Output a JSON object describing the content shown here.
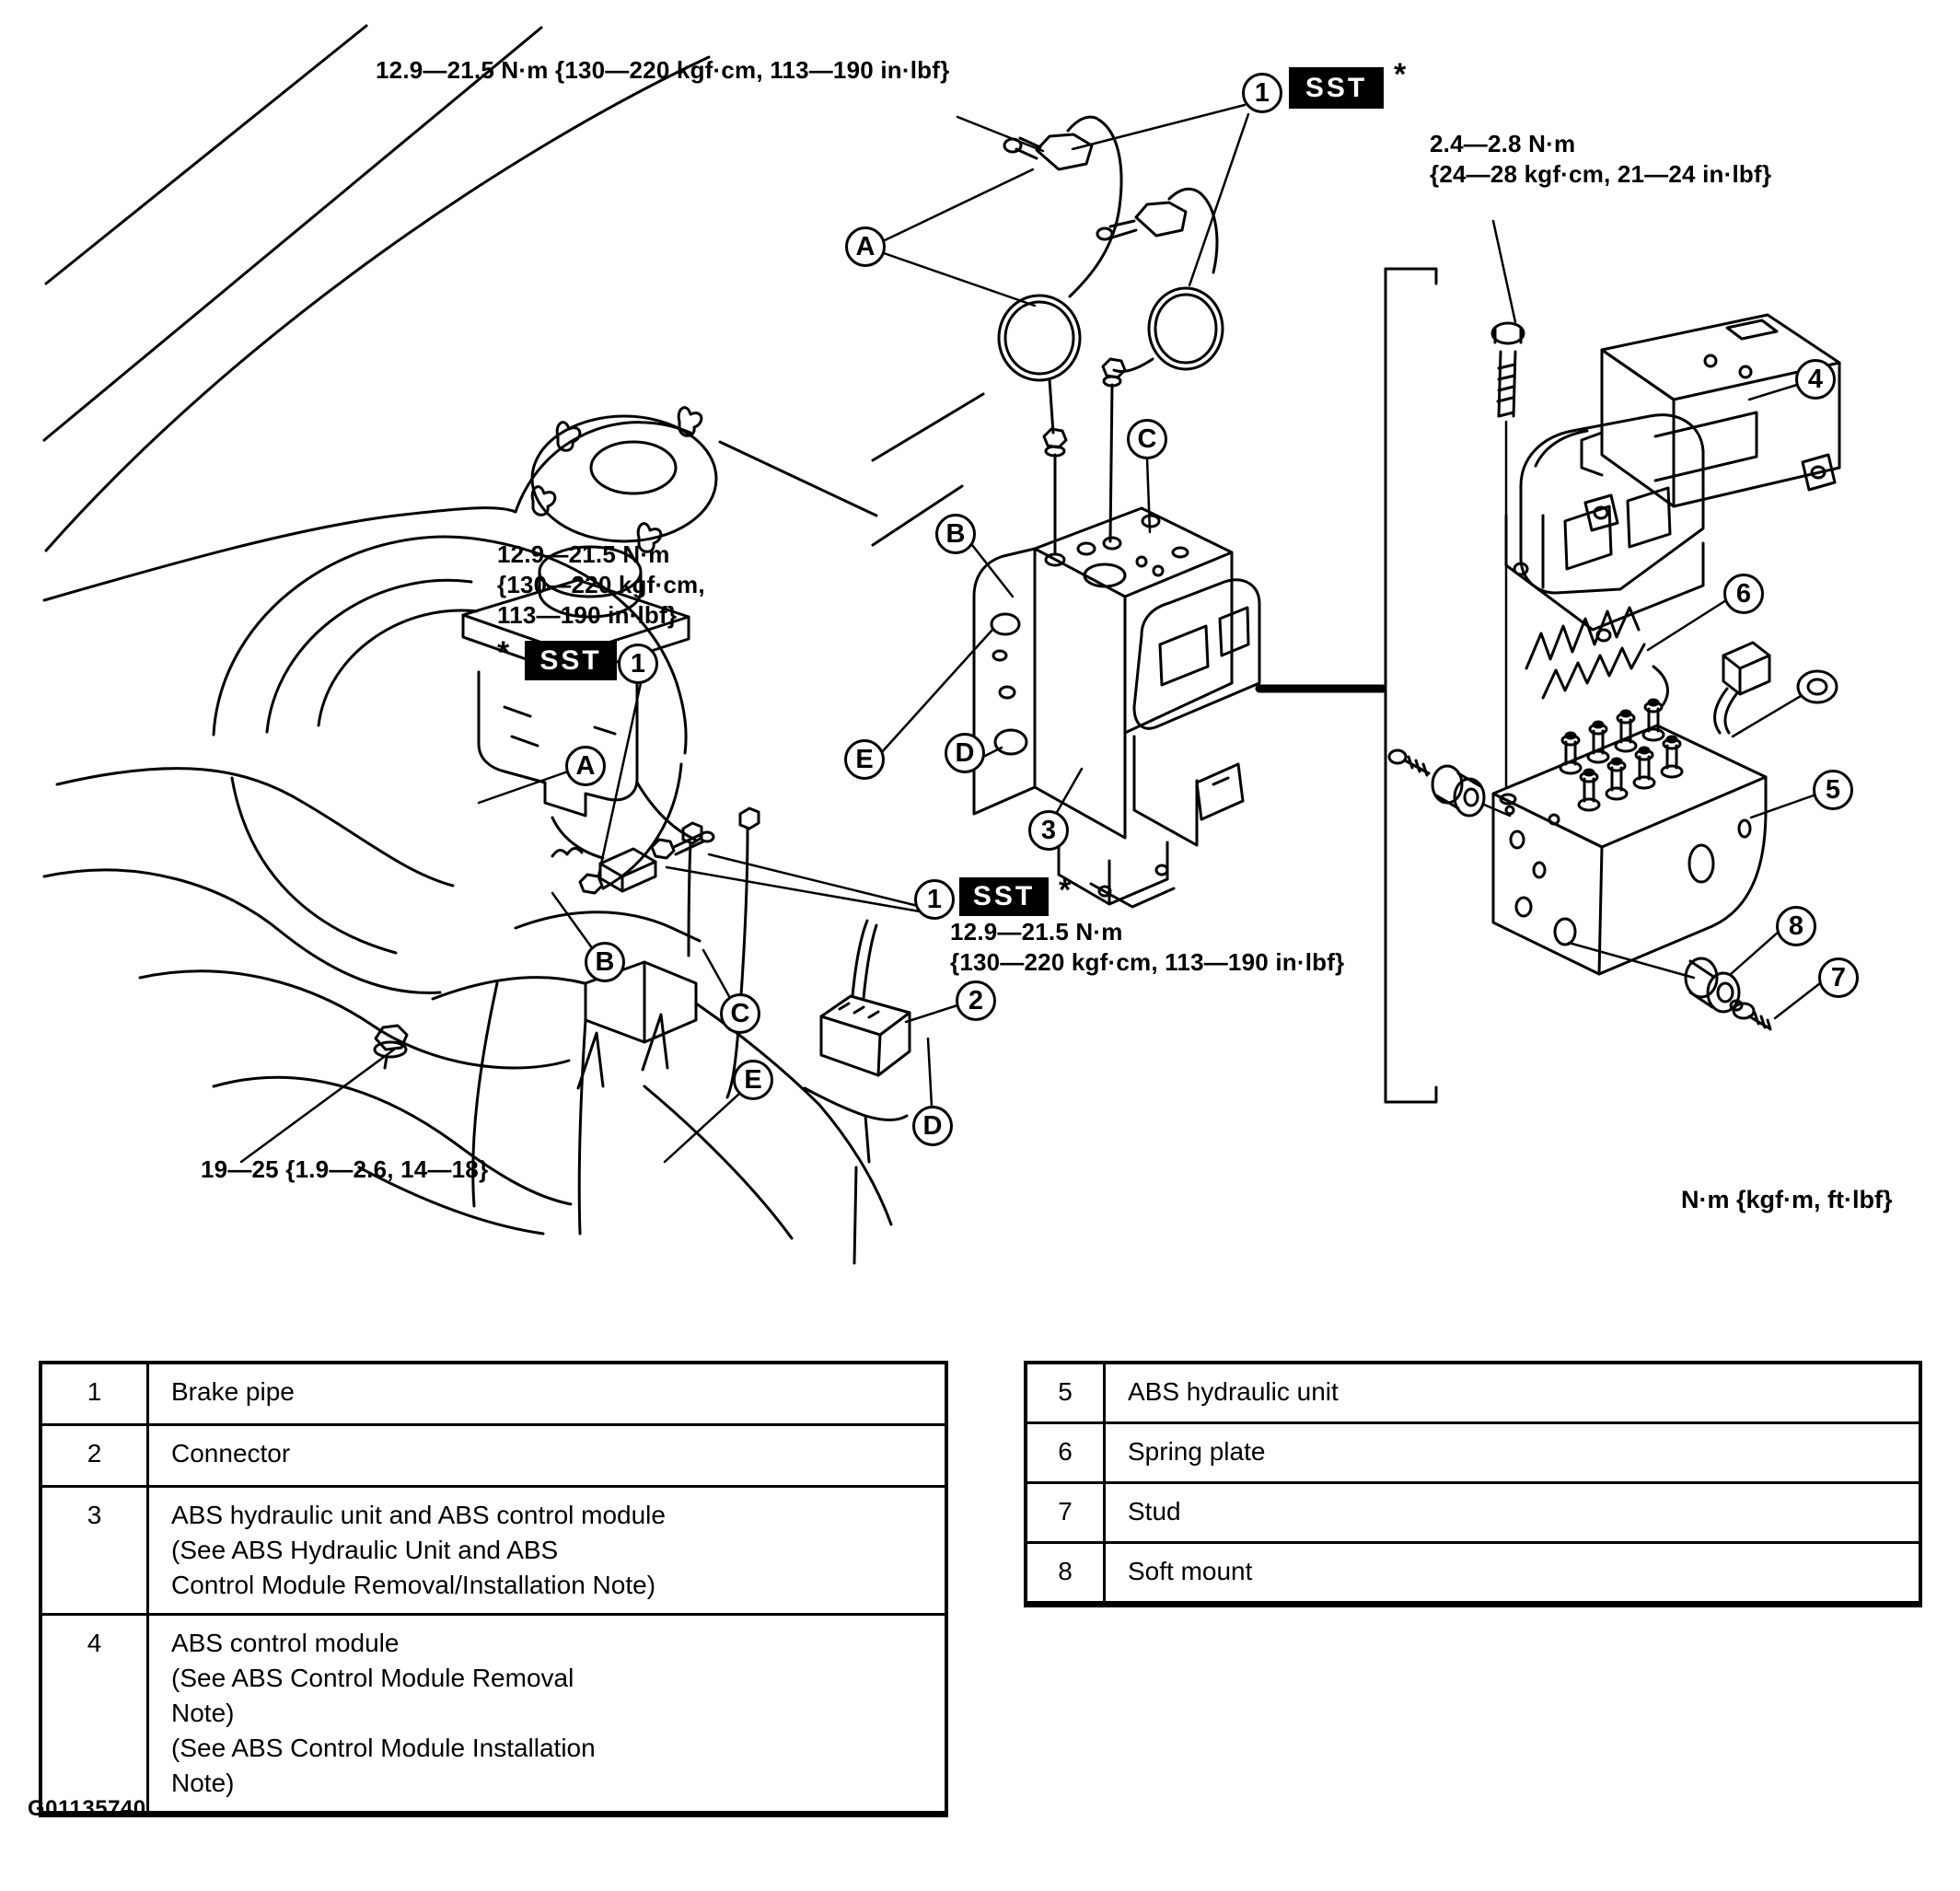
{
  "figure": {
    "id": "G01135740",
    "units_note": "N·m {kgf·m, ft·lbf}"
  },
  "sst": {
    "label": "SST",
    "asterisk": "*"
  },
  "torque_labels": {
    "top": "12.9—21.5 N·m {130—220 kgf·cm, 113—190 in·lbf}",
    "right": "2.4—2.8 N·m\n{24—28 kgf·cm, 21—24 in·lbf}",
    "mid_left": "12.9—21.5 N·m\n{130—220 kgf·cm,\n113—190 in·lbf}",
    "center": "12.9—21.5 N·m\n{130—220 kgf·cm, 113—190 in·lbf}",
    "bottom_left": "19—25 {1.9—2.6, 14—18}"
  },
  "callouts": [
    {
      "label": "1"
    },
    {
      "label": "A"
    },
    {
      "label": "C"
    },
    {
      "label": "B"
    },
    {
      "label": "E"
    },
    {
      "label": "D"
    },
    {
      "label": "3"
    },
    {
      "label": "A"
    },
    {
      "label": "1"
    },
    {
      "label": "B"
    },
    {
      "label": "C"
    },
    {
      "label": "E"
    },
    {
      "label": "1"
    },
    {
      "label": "2"
    },
    {
      "label": "D"
    },
    {
      "label": "4"
    },
    {
      "label": "6"
    },
    {
      "label": "5"
    },
    {
      "label": "8"
    },
    {
      "label": "7"
    }
  ],
  "legend_left": {
    "rows": [
      {
        "num": "1",
        "desc": "Brake pipe"
      },
      {
        "num": "2",
        "desc": "Connector"
      },
      {
        "num": "3",
        "desc": "ABS hydraulic unit and ABS control module\n(See  ABS Hydraulic Unit and ABS\nControl Module Removal/Installation Note)"
      },
      {
        "num": "4",
        "desc": "ABS control module\n(See ABS Control Module Removal\nNote)\n(See ABS Control Module Installation\nNote)"
      }
    ]
  },
  "legend_right": {
    "rows": [
      {
        "num": "5",
        "desc": "ABS hydraulic unit"
      },
      {
        "num": "6",
        "desc": "Spring plate"
      },
      {
        "num": "7",
        "desc": "Stud"
      },
      {
        "num": "8",
        "desc": "Soft mount"
      }
    ]
  }
}
